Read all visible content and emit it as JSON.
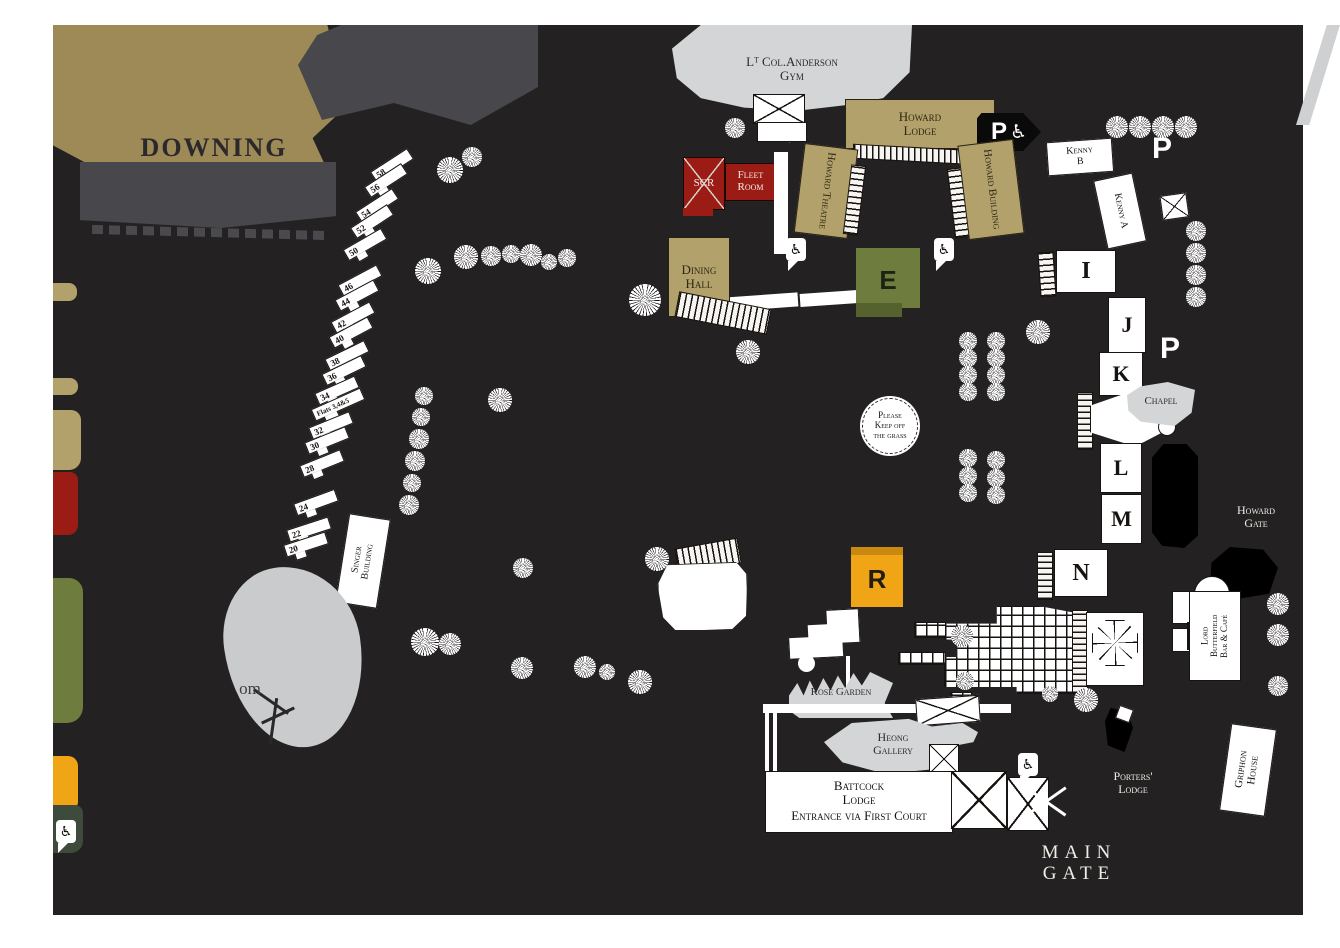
{
  "colors": {
    "map_background": "#242122",
    "gold": "#9d8a57",
    "panel_gray": "#48474b",
    "building_tan": "#b2a16a",
    "accent_red": "#9b1c15",
    "olive_green": "#6e7c3e",
    "amber_orange": "#f0a517",
    "light_gray": "#d3d5d6",
    "dark_green": "#3e4a3b",
    "building_white": "#ffffff",
    "silhouette_black": "#000000"
  },
  "icons": {
    "parking": "P",
    "wheelchair": "♿"
  },
  "titles": {
    "hidden_college": "DOWNING COLLEGE"
  },
  "buildings": {
    "gym": "Lᵀ Col.Anderson\nGym",
    "howard_lodge": "Howard\nLodge",
    "howard_theatre": "Howard Theatre",
    "howard_building": "Howard Building",
    "kenny_b": "Kenny\nB",
    "kenny_a": "Kenny A",
    "scr": "SCR",
    "fleet_room": "Fleet\nRoom",
    "dining_hall": "Dining\nHall",
    "chapel": "Chapel",
    "singer": "Singer\nBuilding",
    "butterfield": "Lord\nButterfield\nBar & Café",
    "griphon": "Griphon\nHouse",
    "battcock": "Battcock\nLodge",
    "battcock_note": "Entrance via First Court",
    "heong": "Heong\nGallery",
    "rose_garden": "Rose Garden",
    "flats": "Flats 3,4&5"
  },
  "letters": {
    "e": "E",
    "i": "I",
    "j": "J",
    "k": "K",
    "l": "L",
    "m": "M",
    "n": "N",
    "r": "R"
  },
  "signs": {
    "grass": "Please\nKeep off\nthe grass",
    "howard_gate": "Howard\nGate",
    "porters_lodge": "Porters'\nLodge",
    "main_gate": "MAIN GATE",
    "paddock_partial": "om"
  },
  "houses": [
    "58",
    "56",
    "54",
    "52",
    "50",
    "46",
    "44",
    "42",
    "40",
    "38",
    "36",
    "34",
    "32",
    "30",
    "28",
    "24",
    "22",
    "20"
  ]
}
